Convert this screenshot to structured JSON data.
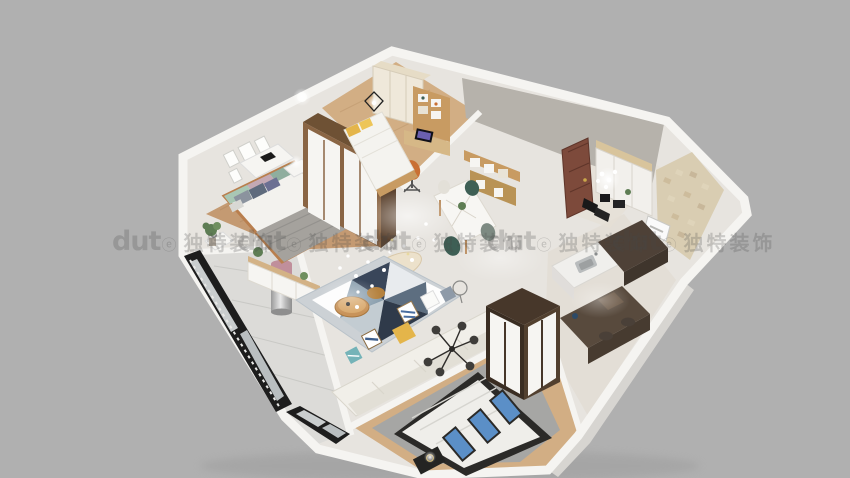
{
  "watermark": {
    "logo_text": "dut",
    "logo_suffix": "ⓔ",
    "brand_text": "独特装饰",
    "color": "rgba(72,72,72,0.24)"
  },
  "colors": {
    "bg": "#b0b0b0",
    "wall_top": "#f5f4f1",
    "wall_face_shadow": "#b6b2ab",
    "wall_face_se": "#d7d5d1",
    "floor_gloss": "#e7e4df",
    "floor_wood": "#c49a72",
    "floor_wood_light": "#d2ae84",
    "floor_balcony": "#dcdbd8",
    "rug_gray": "#a6a6a4",
    "rug_base": "#ccd1d5",
    "panel_white": "#f6f5f2",
    "sofa": "#f1efe9",
    "sofa_shadow": "#e2dfd6",
    "wood_furniture": "#c89b62",
    "wood_dark": "#8a6544",
    "wardrobe_dark": "#47372a",
    "door_red": "#7d4a3b",
    "tile_beige": "#d9cdb2",
    "window_frame": "#1d1d1d",
    "glass": "#c9cdce",
    "accent_teal": "#3e5f55",
    "accent_yellow": "#e4b54a",
    "accent_blue": "#5b8fc7",
    "accent_pink": "#c08f9b",
    "pillow_navy": "#5f6b7d",
    "pillow_green": "#a9c7b4",
    "pillow_mauve": "#c4a9b4",
    "blanket_gray": "#a5a29d",
    "metal_dark": "#3a3a3a",
    "plant_green": "#5e7d54",
    "watermark": "rgba(72,72,72,0.24)"
  }
}
